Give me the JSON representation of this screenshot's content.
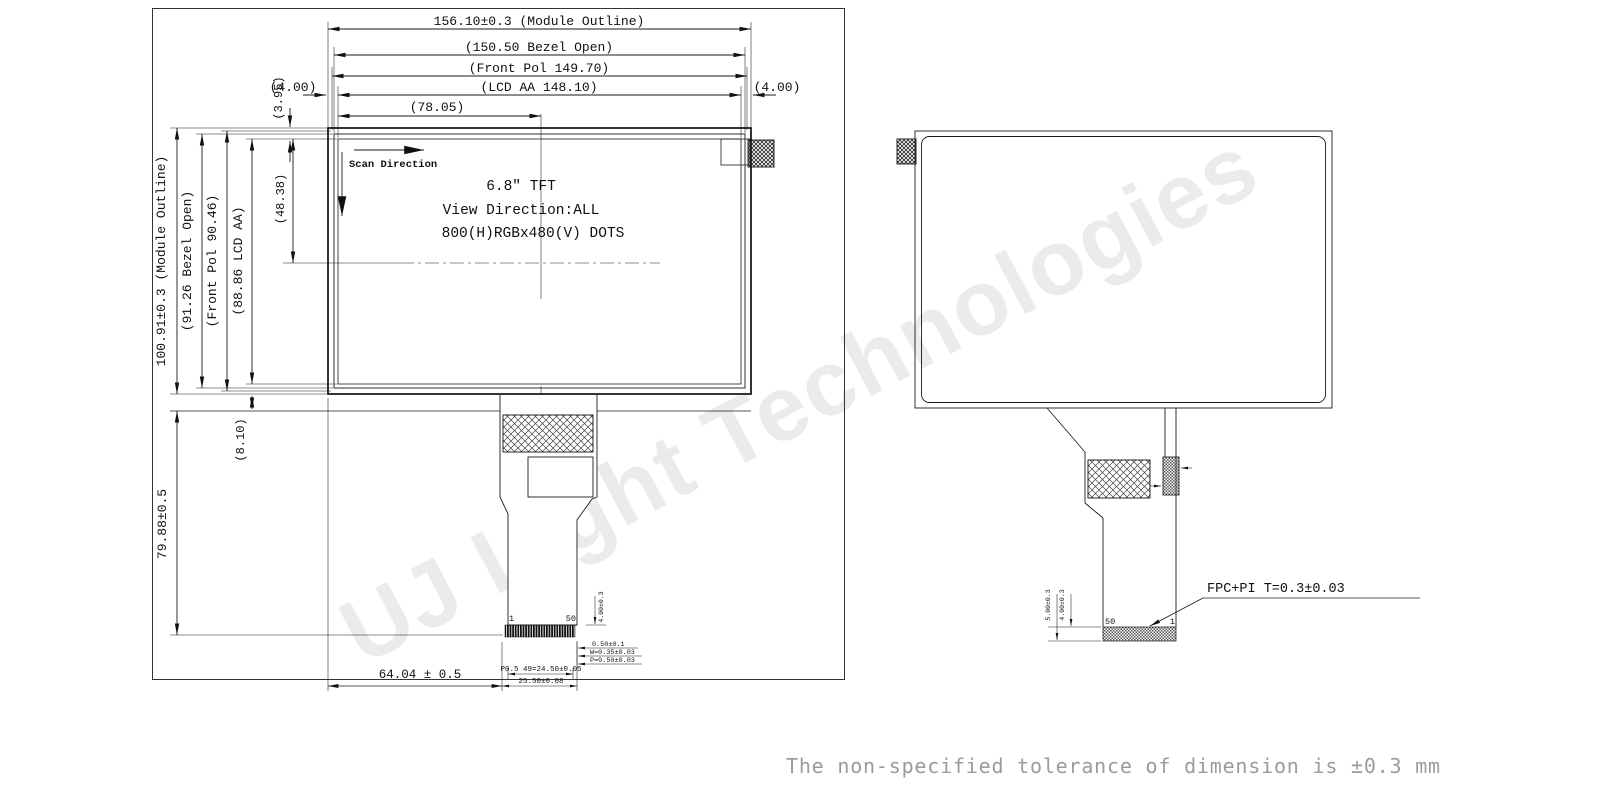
{
  "front_view": {
    "dims_horizontal": {
      "module": "156.10±0.3 (Module Outline)",
      "bezel": "(150.50 Bezel Open)",
      "front_pol": "(Front Pol 149.70)",
      "lcd_aa": "(LCD AA 148.10)",
      "edge_left": "(4.00)",
      "edge_right": "(4.00)",
      "half_width": "(78.05)"
    },
    "dims_vertical": {
      "module": "100.91±0.3 (Module Outline)",
      "bezel": "(91.26 Bezel Open)",
      "front_pol": "(Front Pol 90.46)",
      "lcd_aa": "(88.86 LCD AA)",
      "top_margin": "(3.95)",
      "half_height": "(48.38)",
      "bend_gap": "(8.10)",
      "fpc_length": "79.88±0.5"
    },
    "display_info": {
      "scan_direction": "Scan Direction",
      "size": "6.8″ TFT",
      "view_direction": "View Direction:ALL",
      "resolution": "800(H)RGBx480(V) DOTS"
    },
    "connector": {
      "pin_first": "1",
      "pin_last": "50",
      "offset": "64.04 ± 0.5",
      "contact_length": "4.00±0.3",
      "tip": "0.50±0.1",
      "finger_width": "W=0.35±0.03",
      "finger_pitch": "P=0.50±0.03",
      "pitch_span": "P0.5 49=24.50±0.05",
      "connector_width": "25.50±0.08"
    }
  },
  "rear_view": {
    "connector": {
      "pin_first": "1",
      "pin_last": "50",
      "stiffener_length": "5.00±0.3",
      "contact_length": "4.00±0.3",
      "fpc_spec": "FPC+PI T=0.3±0.03"
    }
  },
  "watermark": "UJ Light Technologies",
  "footer_note": "The non-specified tolerance of dimension is ±0.3 mm"
}
